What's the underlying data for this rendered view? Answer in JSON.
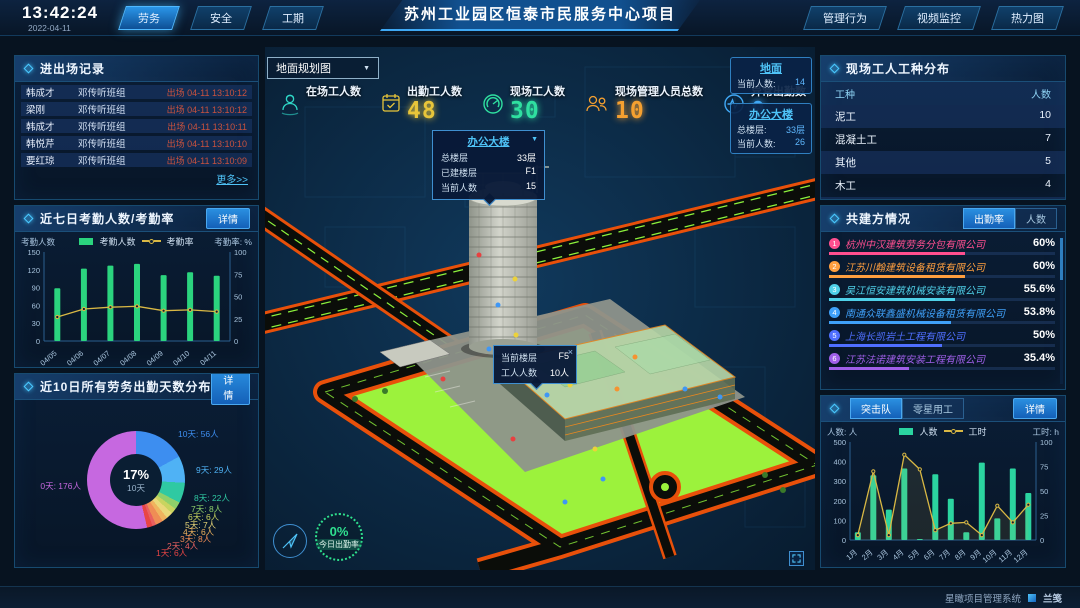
{
  "header": {
    "time": "13:42:24",
    "date": "2022-04-11",
    "nav_left": [
      {
        "label": "劳务",
        "active": true
      },
      {
        "label": "安全",
        "active": false
      },
      {
        "label": "工期",
        "active": false
      }
    ],
    "title": "苏州工业园区恒泰市民服务中心项目",
    "nav_right": [
      {
        "label": "管理行为"
      },
      {
        "label": "视频监控"
      },
      {
        "label": "热力图"
      }
    ]
  },
  "left": {
    "entry_exit": {
      "title": "进出场记录",
      "rows": [
        {
          "name": "韩成才",
          "group": "邓传听班组",
          "event": "出场 04-11 13:10:12"
        },
        {
          "name": "梁刚",
          "group": "邓传听班组",
          "event": "出场 04-11 13:10:12"
        },
        {
          "name": "韩成才",
          "group": "邓传听班组",
          "event": "出场 04-11 13:10:11"
        },
        {
          "name": "韩悦芹",
          "group": "邓传听班组",
          "event": "出场 04-11 13:10:10"
        },
        {
          "name": "要红琼",
          "group": "邓传听班组",
          "event": "出场 04-11 13:10:09"
        }
      ],
      "more": "更多>>"
    },
    "attendance7": {
      "title": "近七日考勤人数/考勤率",
      "detail": "详情",
      "axis_left": "考勤人数",
      "axis_right": "考勤率: %"
    },
    "distribution10": {
      "title": "近10日所有劳务出勤天数分布",
      "detail": "详情"
    }
  },
  "center": {
    "map_select": "地面规划图",
    "stats": [
      {
        "label": "在场工人数",
        "value": "",
        "color": "#2fd8c8"
      },
      {
        "label": "出勤工人数",
        "value": "48",
        "color": "#e8c53a"
      },
      {
        "label": "现场工人数",
        "value": "30",
        "color": "#2fe0a0"
      },
      {
        "label": "现场管理人员总数",
        "value": "10",
        "color": "#f5a030"
      },
      {
        "label": "异常出勤数",
        "value": "0",
        "color": "#40a8f5"
      }
    ],
    "floor_cards": [
      {
        "title": "地面",
        "rows": [
          {
            "label": "当前人数:",
            "value": "14"
          }
        ]
      },
      {
        "title": "办公大楼",
        "rows": [
          {
            "label": "总楼层:",
            "value": "33层"
          },
          {
            "label": "当前人数:",
            "value": "26"
          }
        ]
      }
    ],
    "tooltip_building": {
      "title": "办公大楼",
      "rows": [
        {
          "label": "总楼层",
          "value": "33层"
        },
        {
          "label": "已建楼层",
          "value": "F1"
        },
        {
          "label": "当前人数",
          "value": "15"
        }
      ]
    },
    "tooltip_floor": {
      "rows": [
        {
          "label": "当前楼层",
          "value": "F5"
        },
        {
          "label": "工人人数",
          "value": "10人"
        }
      ],
      "close": "×"
    },
    "gauge": {
      "value": "0%",
      "label": "今日出勤率"
    }
  },
  "right": {
    "trade_dist": {
      "title": "现场工人工种分布",
      "headers": [
        "工种",
        "人数"
      ],
      "rows": [
        {
          "type": "泥工",
          "count": "10"
        },
        {
          "type": "混凝土工",
          "count": "7"
        },
        {
          "type": "其他",
          "count": "5"
        },
        {
          "type": "木工",
          "count": "4"
        },
        {
          "type": "塔司",
          "count": "4"
        }
      ]
    },
    "partners": {
      "title": "共建方情况",
      "tabs": [
        {
          "label": "出勤率",
          "active": true
        },
        {
          "label": "人数",
          "active": false
        }
      ],
      "rows": [
        {
          "rank": "1",
          "name": "杭州中汉建筑劳务分包有限公司",
          "pct": "60%",
          "color": "#ff4f8f"
        },
        {
          "rank": "2",
          "name": "江苏川翰建筑设备租赁有限公司",
          "pct": "60%",
          "color": "#ff9f3f"
        },
        {
          "rank": "3",
          "name": "吴江恒安建筑机械安装有限公司",
          "pct": "55.6%",
          "color": "#4fd0e8"
        },
        {
          "rank": "4",
          "name": "南通众联鑫盛机械设备租赁有限公司",
          "pct": "53.8%",
          "color": "#3fa0f8"
        },
        {
          "rank": "5",
          "name": "上海长凯岩土工程有限公司",
          "pct": "50%",
          "color": "#4f6fff"
        },
        {
          "rank": "6",
          "name": "江苏法诺建筑安装工程有限公司",
          "pct": "35.4%",
          "color": "#9f5fe8"
        }
      ]
    },
    "assault": {
      "tabs": [
        {
          "label": "突击队",
          "active": true
        },
        {
          "label": "零星用工",
          "active": false
        }
      ],
      "detail": "详情",
      "axis_left": "人数: 人",
      "axis_right": "工时: h"
    }
  },
  "footer": {
    "system": "星瞰项目管理系统",
    "logo": "兰笺"
  },
  "chart_data": [
    {
      "id": "attendance7",
      "type": "bar+line",
      "title": "近七日考勤人数/考勤率",
      "categories": [
        "04/05",
        "04/06",
        "04/07",
        "04/08",
        "04/09",
        "04/10",
        "04/11"
      ],
      "series": [
        {
          "name": "考勤人数",
          "type": "bar",
          "axis": "left",
          "color": "#2bd47e",
          "values": [
            89,
            122,
            127,
            130,
            111,
            116,
            110
          ]
        },
        {
          "name": "考勤率",
          "type": "line",
          "axis": "right",
          "color": "#d9b844",
          "values": [
            27,
            36,
            38,
            39,
            34,
            35,
            33
          ]
        }
      ],
      "ylabel_left": "考勤人数",
      "ylabel_right": "考勤率: %",
      "ylim_left": [
        0,
        150
      ],
      "ylim_right": [
        0,
        100
      ],
      "yticks_left": [
        0,
        30,
        60,
        90,
        120,
        150
      ],
      "yticks_right": [
        0,
        25,
        50,
        75,
        100
      ],
      "legend_position": "top",
      "grid": false
    },
    {
      "id": "attendance_days_distribution",
      "type": "pie",
      "title": "近10日所有劳务出勤天数分布",
      "slices": [
        {
          "label": "10天",
          "value": 56,
          "text": "10天: 56人",
          "color": "#3d8ef0"
        },
        {
          "label": "9天",
          "value": 29,
          "text": "9天: 29人",
          "color": "#4fb2f5"
        },
        {
          "label": "8天",
          "value": 22,
          "text": "8天: 22人",
          "color": "#2fc9a2"
        },
        {
          "label": "7天",
          "value": 8,
          "text": "7天: 8人",
          "color": "#8fd06a"
        },
        {
          "label": "6天",
          "value": 6,
          "text": "6天: 6人",
          "color": "#c9d45f"
        },
        {
          "label": "5天",
          "value": 7,
          "text": "5天: 7人",
          "color": "#ead879"
        },
        {
          "label": "4天",
          "value": 6,
          "text": "4天: 6人",
          "color": "#f0b35e"
        },
        {
          "label": "3天",
          "value": 8,
          "text": "3天: 8人",
          "color": "#ef8d55"
        },
        {
          "label": "2天",
          "value": 4,
          "text": "2天: 4人",
          "color": "#e86060"
        },
        {
          "label": "1天",
          "value": 6,
          "text": "1天: 6人",
          "color": "#e84545"
        },
        {
          "label": "0天",
          "value": 176,
          "text": "0天: 176人",
          "color": "#c668e0"
        }
      ],
      "center": {
        "pct": "17%",
        "label": "10天"
      }
    },
    {
      "id": "assault_team",
      "type": "bar+line",
      "title": "突击队",
      "categories": [
        "1月",
        "2月",
        "3月",
        "4月",
        "5月",
        "6月",
        "7月",
        "8月",
        "9月",
        "10月",
        "11月",
        "12月"
      ],
      "series": [
        {
          "name": "人数",
          "type": "bar",
          "axis": "left",
          "color": "#2bd4a0",
          "values": [
            40,
            330,
            155,
            365,
            5,
            335,
            210,
            40,
            395,
            110,
            365,
            240
          ]
        },
        {
          "name": "工时",
          "type": "line",
          "axis": "right",
          "color": "#d9b844",
          "values": [
            5,
            70,
            5,
            87,
            72,
            10,
            17,
            18,
            5,
            35,
            18,
            36
          ]
        }
      ],
      "ylabel_left": "人数: 人",
      "ylabel_right": "工时: h",
      "ylim_left": [
        0,
        500
      ],
      "ylim_right": [
        0,
        100
      ],
      "yticks_left": [
        0,
        100,
        200,
        300,
        400,
        500
      ],
      "yticks_right": [
        0,
        25,
        50,
        75,
        100
      ],
      "legend_position": "top",
      "grid": false
    }
  ]
}
